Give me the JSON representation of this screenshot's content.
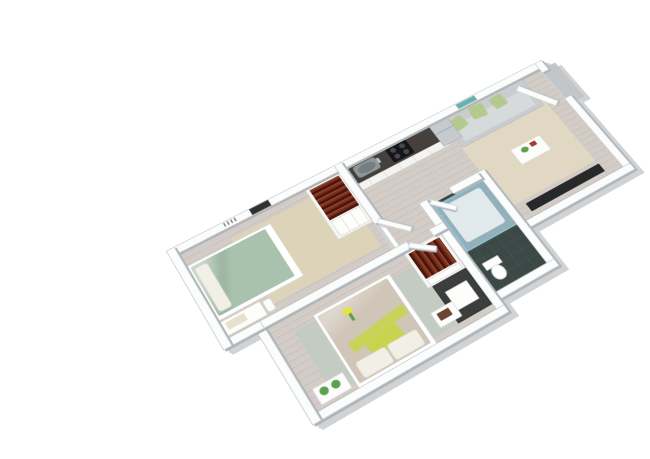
{
  "image_type": "3d-isometric-floor-plan-rendering",
  "visible_text": [],
  "palette": {
    "bg": "#ffffff",
    "wood": "#d3ccc6",
    "wall": "#fbfcfc",
    "wall_edge": "#c9ced1",
    "wall_shadow": "#aeb4b8",
    "platform_gray": "#c2c6c9",
    "rug_beige": "#e0d8c2",
    "rug_tan": "#ddd3b8",
    "rug_sage_gray": "#c3cbc3",
    "sofa": "#c9cdcf",
    "sofa_seat": "#d6dadb",
    "pillow_green": "#b4ca8c",
    "art_teal": "#66b2ac",
    "tv_dark": "#26282a",
    "counter_dark": "#45403c",
    "steel": "#8f979b",
    "stove_dark": "#141517",
    "cabinet_white": "#f4f4f2",
    "clothes_dark_red": "#7b2c1c",
    "clothes_deep": "#4a170e",
    "duvet_sage": "#a9c2ad",
    "duvet_taupe": "#d0c6b8",
    "pillow_white": "#f1efe6",
    "accent_chartreuse": "#c8d44f",
    "plant_green": "#5da04e",
    "bath_floor": "#3c4845",
    "shower_glass": "rgba(173,211,226,0.75)",
    "shower_glass_edge": "#8ec2d2",
    "porcelain": "#fdfdfc",
    "frame_dark": "#303030",
    "desk_dark": "#3c3e3d",
    "books_brown": "#6e4434",
    "flower_yellow": "#e8e23e"
  },
  "rooms": {
    "living": {
      "label": "living-room"
    },
    "kitchen": {
      "label": "kitchen"
    },
    "hallway": {
      "label": "hallway"
    },
    "bathroom": {
      "label": "bathroom"
    },
    "bedroom1": {
      "label": "bedroom-small"
    },
    "master": {
      "label": "bedroom-master"
    }
  },
  "furniture": {
    "sofa": "gray-sofa-with-green-pillows",
    "coffee_table": "white-coffee-table-with-plant",
    "tv": "flat-screen-tv",
    "wall_art_living": "teal-wall-art",
    "entry_door": "entry-door-open",
    "counter": "kitchen-counter-dark",
    "sink": "kitchen-sink",
    "stove": "stove-cooktop",
    "fridge": "refrigerator",
    "bed1": "bed-sage-duvet",
    "bench1": "foot-bench-with-cushion",
    "lamp1": "table-lamp",
    "closet1": "open-closet-clothes",
    "picture1": "dark-framed-picture",
    "shower": "glass-shower-enclosure",
    "toilet": "toilet",
    "closet2": "open-closet-clothes",
    "desk": "dark-desk-with-storage-box",
    "bed2": "double-bed-taupe-duvet-chartreuse-pillows",
    "nightstand_plants": "white-nightstand-with-plants",
    "side_table_books": "white-side-table-with-books",
    "flowers": "yellow-flowers-decor"
  }
}
